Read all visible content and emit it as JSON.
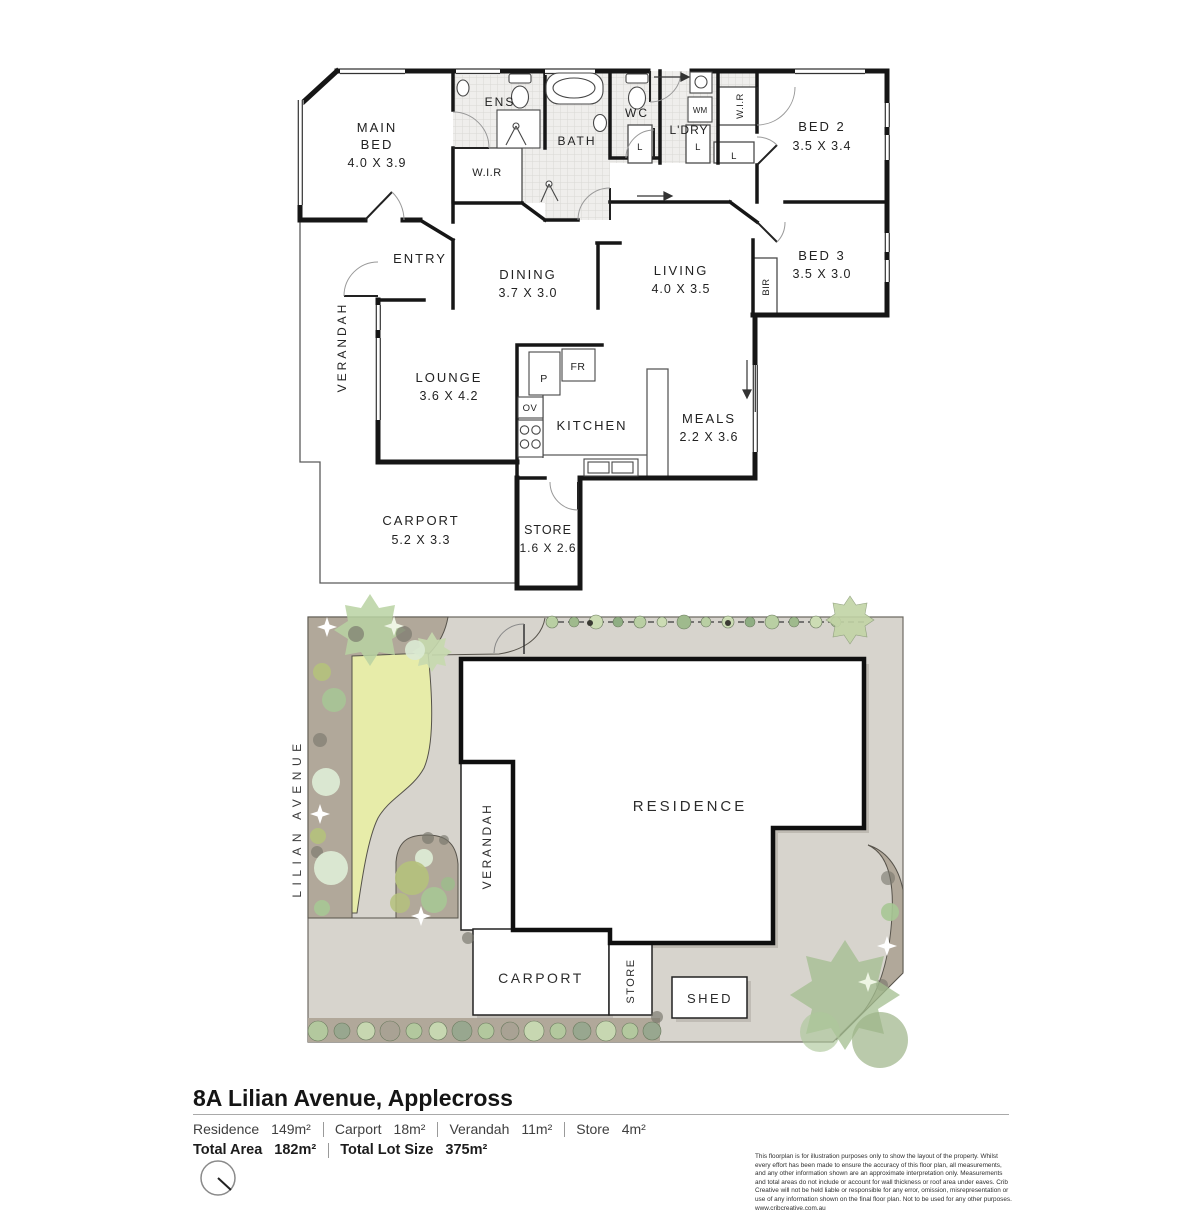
{
  "floorplan": {
    "rooms": {
      "main_bed": {
        "line1": "MAIN",
        "line2": "BED",
        "dims": "4.0 X 3.9"
      },
      "ens": {
        "name": "ENS"
      },
      "bath": {
        "name": "BATH"
      },
      "wc": {
        "name": "WC"
      },
      "ldry": {
        "name": "L'DRY"
      },
      "wir": {
        "name": "W.I.R"
      },
      "bed2": {
        "name": "BED 2",
        "dims": "3.5 X 3.4"
      },
      "bed3": {
        "name": "BED 3",
        "dims": "3.5 X 3.0"
      },
      "bir": {
        "name": "BIR"
      },
      "entry": {
        "name": "ENTRY"
      },
      "dining": {
        "name": "DINING",
        "dims": "3.7 X 3.0"
      },
      "living": {
        "name": "LIVING",
        "dims": "4.0 X 3.5"
      },
      "verandah": {
        "name": "VERANDAH"
      },
      "lounge": {
        "name": "LOUNGE",
        "dims": "3.6 X 4.2"
      },
      "kitchen": {
        "name": "KITCHEN"
      },
      "meals": {
        "name": "MEALS",
        "dims": "2.2 X 3.6"
      },
      "carport": {
        "name": "CARPORT",
        "dims": "5.2 X 3.3"
      },
      "store": {
        "name": "STORE",
        "dims": "1.6 X 2.6"
      }
    },
    "fixtures": {
      "pantry": "P",
      "fridge": "FR",
      "oven": "OV",
      "washing_machine": "WM",
      "linen": "L"
    }
  },
  "siteplan": {
    "street": "LILIAN AVENUE",
    "labels": {
      "residence": "RESIDENCE",
      "verandah": "VERANDAH",
      "carport": "CARPORT",
      "store": "STORE",
      "shed": "SHED"
    }
  },
  "footer": {
    "address": "8A Lilian Avenue, Applecross",
    "areas": [
      {
        "label": "Residence",
        "value": "149m²"
      },
      {
        "label": "Carport",
        "value": "18m²"
      },
      {
        "label": "Verandah",
        "value": "11m²"
      },
      {
        "label": "Store",
        "value": "4m²"
      }
    ],
    "totals": [
      {
        "label": "Total Area",
        "value": "182m²"
      },
      {
        "label": "Total Lot Size",
        "value": "375m²"
      }
    ],
    "disclaimer": "This floorplan is for illustration purposes only to show the layout of the property. Whilst every effort has been made to ensure the accuracy of this floor plan, all measurements, and any other information shown are an approximate interpretation only. Measurements and total areas do not include or account for wall thickness or roof area under eaves. Crib Creative will not be held liable or responsible for any error, omission, misrepresentation or use of any information shown on the final floor plan. Not to be used for any other purposes.",
    "website": "www.cribcreative.com.au"
  }
}
